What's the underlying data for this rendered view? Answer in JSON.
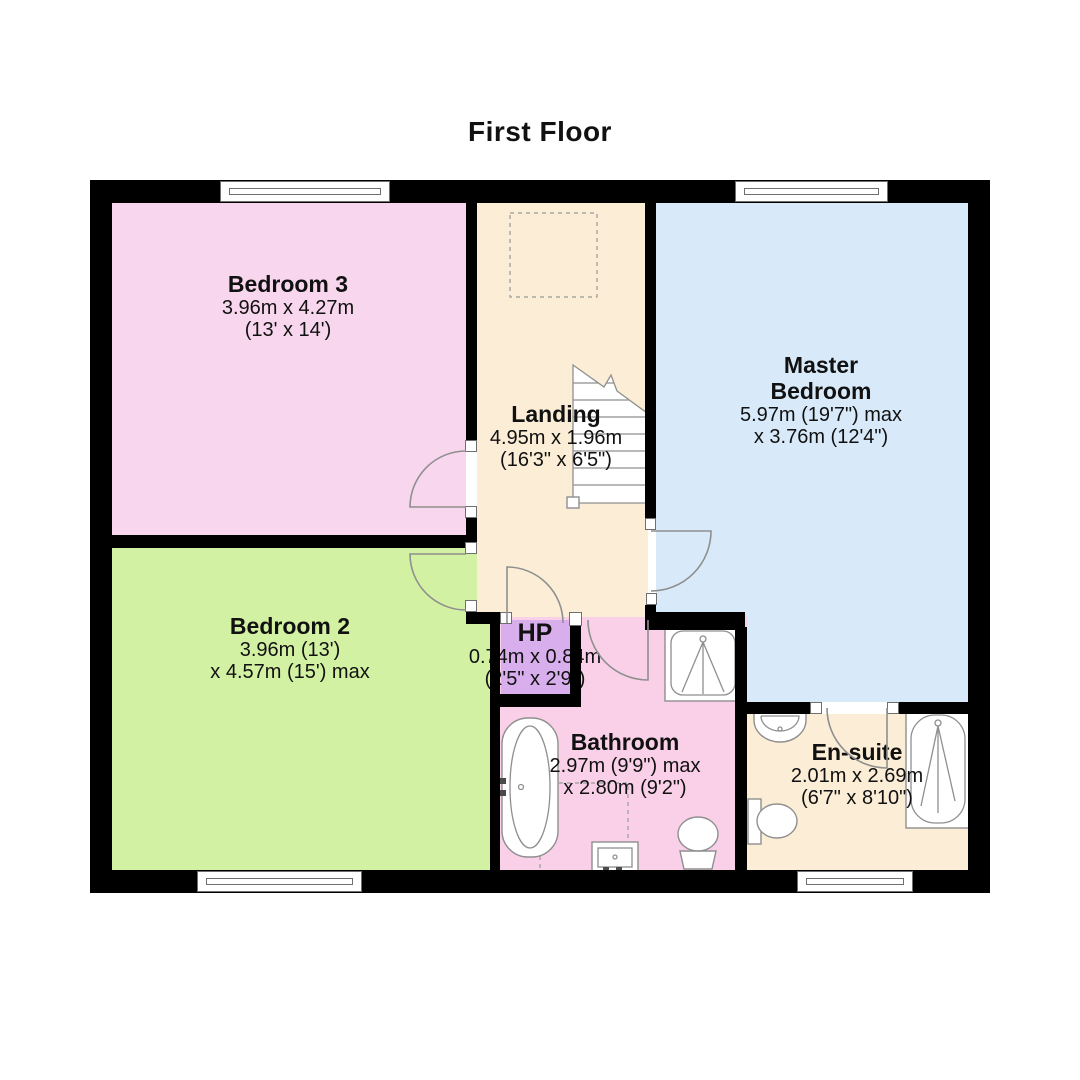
{
  "title": "First Floor",
  "colors": {
    "wall": "#000000",
    "bedroom3": "#f8d7ee",
    "bedroom2": "#d3f1a3",
    "landing": "#fbedd6",
    "master_bedroom": "#d8eaf9",
    "hp": "#d8afec",
    "bathroom": "#f9d0e8",
    "ensuite": "#fbedd6",
    "fixture_outline": "#8f8f8f"
  },
  "rooms": {
    "bedroom3": {
      "name": "Bedroom 3",
      "dims_metric": "3.96m x 4.27m",
      "dims_imperial": "(13' x 14')"
    },
    "bedroom2": {
      "name": "Bedroom 2",
      "dims_metric": "3.96m (13')",
      "dims_imperial": "x 4.57m (15') max"
    },
    "landing": {
      "name": "Landing",
      "dims_metric": "4.95m x 1.96m",
      "dims_imperial": "(16'3\" x 6'5\")"
    },
    "master_bedroom": {
      "name": "Master Bedroom",
      "dims_metric": "5.97m (19'7\") max",
      "dims_imperial": "x 3.76m (12'4\")"
    },
    "hp": {
      "name": "HP",
      "dims_metric": "0.74m x 0.84m",
      "dims_imperial": "(2'5\" x 2'9\")"
    },
    "bathroom": {
      "name": "Bathroom",
      "dims_metric": "2.97m (9'9\") max",
      "dims_imperial": "x 2.80m (9'2\")"
    },
    "ensuite": {
      "name": "En-suite",
      "dims_metric": "2.01m x 2.69m",
      "dims_imperial": "(6'7\" x 8'10\")"
    }
  },
  "fixtures": [
    "stairs",
    "loft-hatch",
    "bath",
    "shower",
    "sink",
    "toilet",
    "shower-bath"
  ]
}
